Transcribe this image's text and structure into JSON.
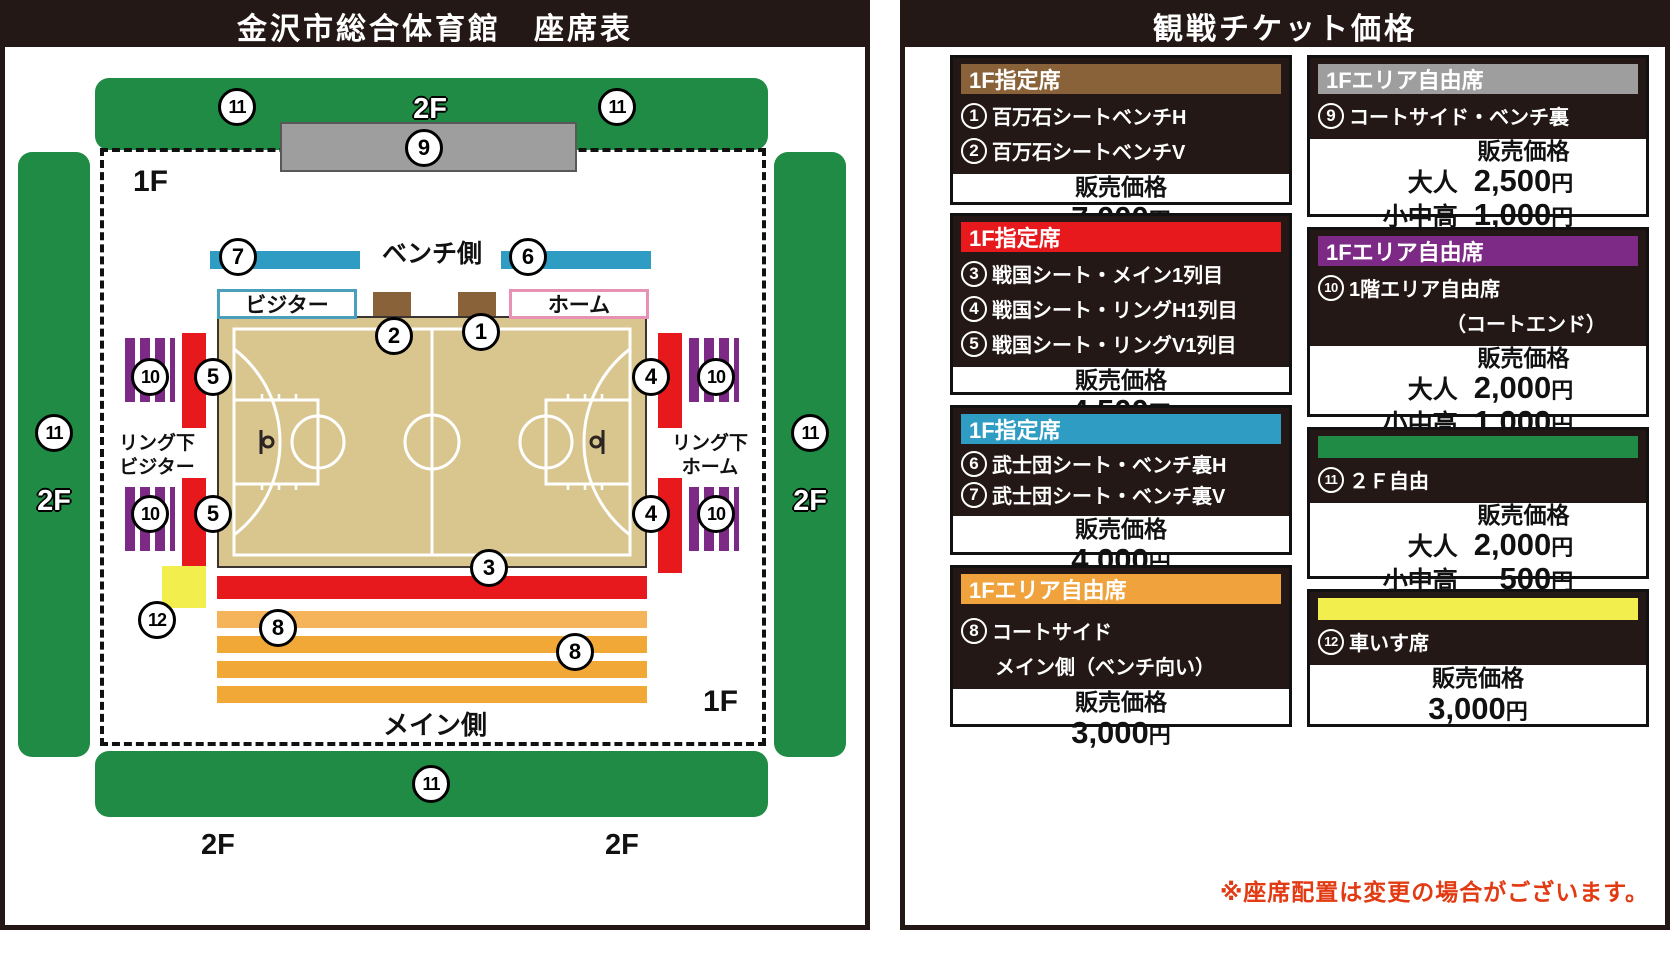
{
  "nums": {
    "n1": "1",
    "n2": "2",
    "n3": "3",
    "n4": "4",
    "n5": "5",
    "n6": "6",
    "n7": "7",
    "n8": "8",
    "n9": "9",
    "n10": "10",
    "n11": "11",
    "n12": "12"
  },
  "colors": {
    "ink": "#231815",
    "green": "#1f8b45",
    "gray": "#9e9e9e",
    "red": "#e8191c",
    "blue": "#2e9cc3",
    "brown": "#8a6239",
    "purple": "#7c2a85",
    "orange": "#f0a23c",
    "yellow": "#f2ee4e",
    "court": "#d9c68f",
    "amber": "#f2a837",
    "amberlight": "#f5b45a",
    "footer-red": "#e23a12",
    "home-pink": "#e791b4",
    "visitor-blue": "#4aa0bc"
  },
  "left_panel": {
    "title": "金沢市総合体育館　座席表",
    "f1": "1F",
    "f2": "2F",
    "bench_side": "ベンチ側",
    "main_side": "メイン側",
    "visitor": "ビジター",
    "home": "ホーム",
    "ring_visitor_line1": "リング下",
    "ring_visitor_line2": "ビジター",
    "ring_home_line1": "リング下",
    "ring_home_line2": "ホーム"
  },
  "right_panel": {
    "title": "観戦チケット価格",
    "footer_note": "※座席配置は変更の場合がございます。",
    "boxes": [
      {
        "header": "1F指定席",
        "header_color": "#8a6239",
        "price_label": "販売価格",
        "rows": [
          {
            "n": "1",
            "t": "百万石シートベンチH"
          },
          {
            "n": "2",
            "t": "百万石シートベンチV"
          }
        ],
        "prices": [
          {
            "l": "",
            "v": "7,000",
            "u": "円"
          }
        ]
      },
      {
        "header": "1F指定席",
        "header_color": "#e8191c",
        "price_label": "販売価格",
        "rows": [
          {
            "n": "3",
            "t": "戦国シート・メイン1列目"
          },
          {
            "n": "4",
            "t": "戦国シート・リングH1列目"
          },
          {
            "n": "5",
            "t": "戦国シート・リングV1列目"
          }
        ],
        "prices": [
          {
            "l": "",
            "v": "4,500",
            "u": "円"
          }
        ]
      },
      {
        "header": "1F指定席",
        "header_color": "#2e9cc3",
        "price_label": "販売価格",
        "rows": [
          {
            "n": "6",
            "t": "武士団シート・ベンチ裏H"
          },
          {
            "n": "7",
            "t": "武士団シート・ベンチ裏V"
          }
        ],
        "prices": [
          {
            "l": "",
            "v": "4,000",
            "u": "円"
          }
        ]
      },
      {
        "header": "1Fエリア自由席",
        "header_color": "#f0a23c",
        "price_label": "販売価格",
        "rows": [
          {
            "n": "8",
            "t": "コートサイド"
          },
          {
            "n": "",
            "t": "メイン側（ベンチ向い）"
          }
        ],
        "prices": [
          {
            "l": "",
            "v": "3,000",
            "u": "円"
          }
        ]
      },
      {
        "header": "1Fエリア自由席",
        "header_color": "#9e9e9e",
        "price_label": "販売価格",
        "rows": [
          {
            "n": "9",
            "t": "コートサイド・ベンチ裏"
          }
        ],
        "prices": [
          {
            "l": "大人",
            "v": "2,500",
            "u": "円"
          },
          {
            "l": "小中高",
            "v": "1,000",
            "u": "円"
          }
        ]
      },
      {
        "header": "1Fエリア自由席",
        "header_color": "#7c2a85",
        "price_label": "販売価格",
        "rows": [
          {
            "n": "10",
            "t": "1階エリア自由席"
          },
          {
            "n": "",
            "t": "（コートエンド）"
          }
        ],
        "prices": [
          {
            "l": "大人",
            "v": "2,000",
            "u": "円"
          },
          {
            "l": "小中高",
            "v": "1,000",
            "u": "円"
          }
        ]
      },
      {
        "header": "",
        "header_color": "#1f8b45",
        "price_label": "販売価格",
        "rows": [
          {
            "n": "11",
            "t": "２Ｆ自由"
          }
        ],
        "prices": [
          {
            "l": "大人",
            "v": "2,000",
            "u": "円"
          },
          {
            "l": "小中高",
            "v": "500",
            "u": "円"
          }
        ]
      },
      {
        "header": "",
        "header_color": "#f2ee4e",
        "price_label": "販売価格",
        "rows": [
          {
            "n": "12",
            "t": "車いす席"
          }
        ],
        "prices": [
          {
            "l": "",
            "v": "3,000",
            "u": "円"
          }
        ]
      }
    ]
  }
}
